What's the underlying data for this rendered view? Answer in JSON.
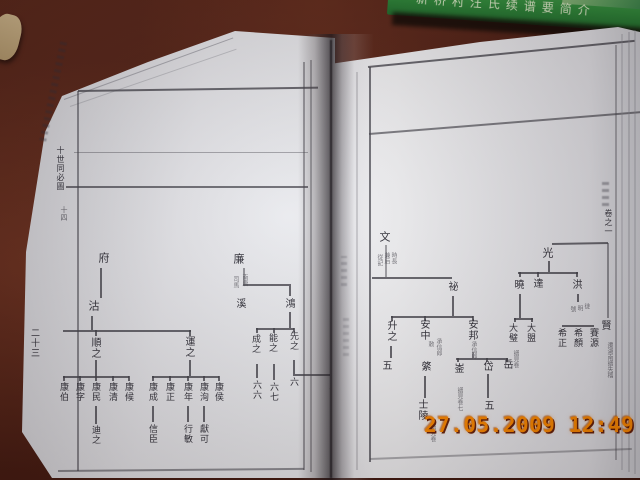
{
  "photo": {
    "timestamp": "27.05.2009 12:49",
    "timestamp_color": "#ff8a00",
    "table_color": "#4e2016",
    "green_book_color": "#2e8c3c",
    "green_book_title": "新桥村汪氏续谱要简介"
  },
  "left_page": {
    "page_number": "二十三",
    "margin_chart_title": "十世同必圖",
    "margin_chart_sub": "十四",
    "tree_fu": {
      "root": "府",
      "gen2": "沽",
      "shun": "順之",
      "shun_children": [
        "康伯",
        "康字",
        "康民",
        "康清",
        "康候"
      ],
      "shun_grandchild": "迪之",
      "yun": "運之",
      "yun_children": [
        "康成",
        "康正",
        "康年",
        "康洵",
        "康侯"
      ],
      "yun_grandchildren": [
        "信臣",
        "行敏",
        "獻可"
      ]
    },
    "tree_lian": {
      "root": "廉",
      "root_note": [
        "南唐",
        "司馬"
      ],
      "gen2": [
        "溪",
        "鴻"
      ],
      "hong_children": [
        "成之",
        "能之",
        "先之"
      ],
      "descend_numbers": [
        "六六",
        "六七",
        "六"
      ],
      "extra_number": "五"
    }
  },
  "right_page": {
    "edge_volume_label": "卷之一",
    "edge_migration_note": "遷湖南譜失稽",
    "tree_wen": {
      "root": "文",
      "root_note": [
        "時長",
        "兼后",
        "從記"
      ],
      "mi": "祕",
      "sheng": "升之",
      "sheng_number": "五",
      "anzhong": "安中",
      "anzhong_note": [
        "敕",
        "承信郎"
      ],
      "anzhong_child": "綮",
      "anzhong_grandchild": "士陵",
      "anzhong_grandchild_note": "譜見卷",
      "anbang": "安邦",
      "anbang_note": "承信郎",
      "anbang_children": [
        "崟",
        "岱",
        "岳"
      ],
      "yin_note": "譜見卷七",
      "dai_number": "五"
    },
    "tree_guang": {
      "root": "光",
      "sibling": "賢",
      "children": [
        "曉",
        "達",
        "洪"
      ],
      "xiao_children": [
        "大璧",
        "大盟"
      ],
      "xiao_note": "譜見卷",
      "hong_note": [
        "徙",
        "明",
        "號"
      ],
      "hong_children": [
        "希正",
        "希顏",
        "賽源"
      ]
    }
  }
}
